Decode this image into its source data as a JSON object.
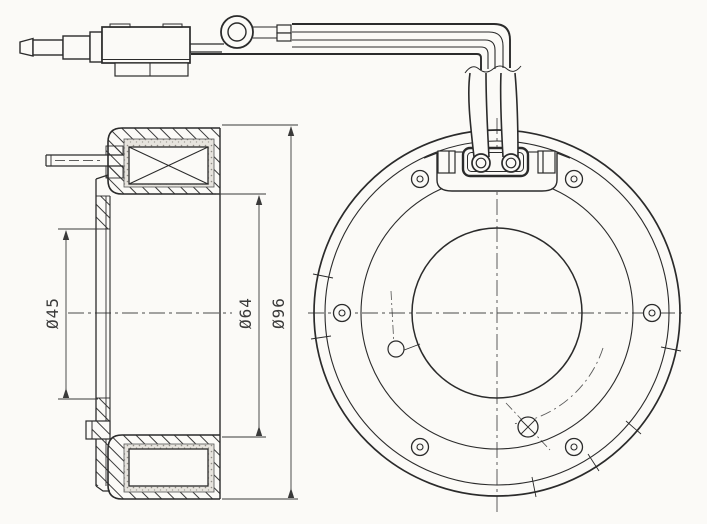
{
  "drawing": {
    "type": "engineering-drawing",
    "subject": "electromagnetic clutch coil assembly - side section and front view",
    "background_color": "#fbfaf7",
    "line_color": "#2b2b2b",
    "dimensions": {
      "inner": {
        "label": "Ø45"
      },
      "middle": {
        "label": "Ø64"
      },
      "outer": {
        "label": "Ø96"
      }
    }
  }
}
